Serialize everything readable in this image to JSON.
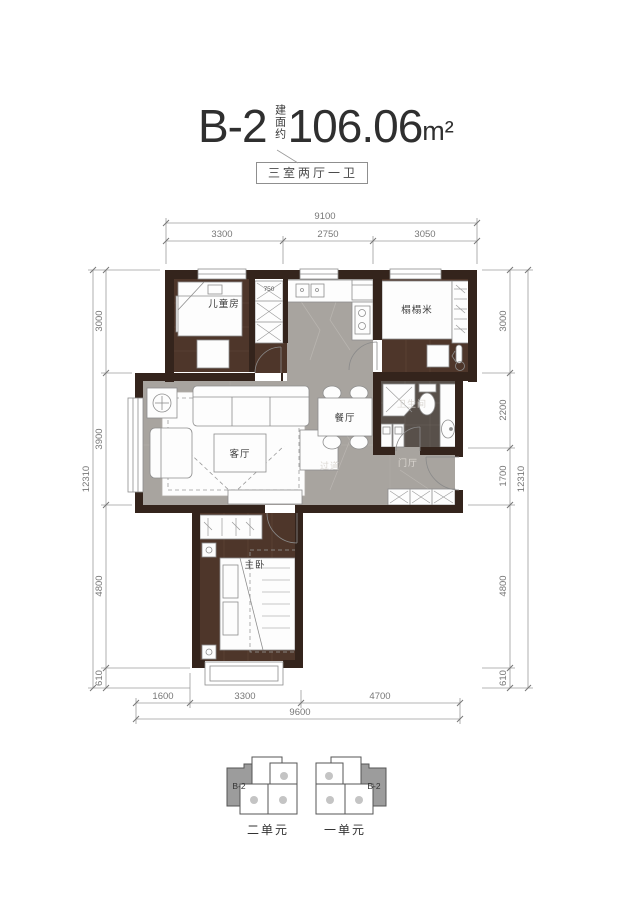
{
  "header": {
    "unit_name": "B-2",
    "area_label": "建面约",
    "area_value": "106.06",
    "area_unit": "m²",
    "layout_badge": "三室两厅一卫"
  },
  "rooms": {
    "children": "儿童房",
    "tatami": "榻榻米",
    "living": "客厅",
    "dining": "餐厅",
    "bathroom": "卫生间",
    "corridor": "过道",
    "foyer": "门厅",
    "master": "主卧",
    "closet_width": "750"
  },
  "dimensions": {
    "top": {
      "total": "9100",
      "segments": [
        "3300",
        "2750",
        "3050"
      ]
    },
    "bottom": {
      "total": "9600",
      "segments": [
        "1600",
        "3300",
        "4700"
      ]
    },
    "left": {
      "total": "12310",
      "segments": [
        "3000",
        "3900",
        "4800",
        "610"
      ]
    },
    "right": {
      "total": "12310",
      "segments": [
        "3000",
        "2200",
        "1700",
        "4800",
        "610"
      ]
    }
  },
  "key_plan": {
    "left_building": {
      "tag": "B-2",
      "name": "二单元"
    },
    "right_building": {
      "tag": "B-2",
      "name": "一单元"
    }
  },
  "colors": {
    "wall": "#34241c",
    "wood_floor": "#4e362a",
    "marble_floor": "#a8a49f",
    "bath_tile": "#58504a",
    "keyplan_gray": "#9c9c9c",
    "dim_line": "#9b9b9b"
  }
}
